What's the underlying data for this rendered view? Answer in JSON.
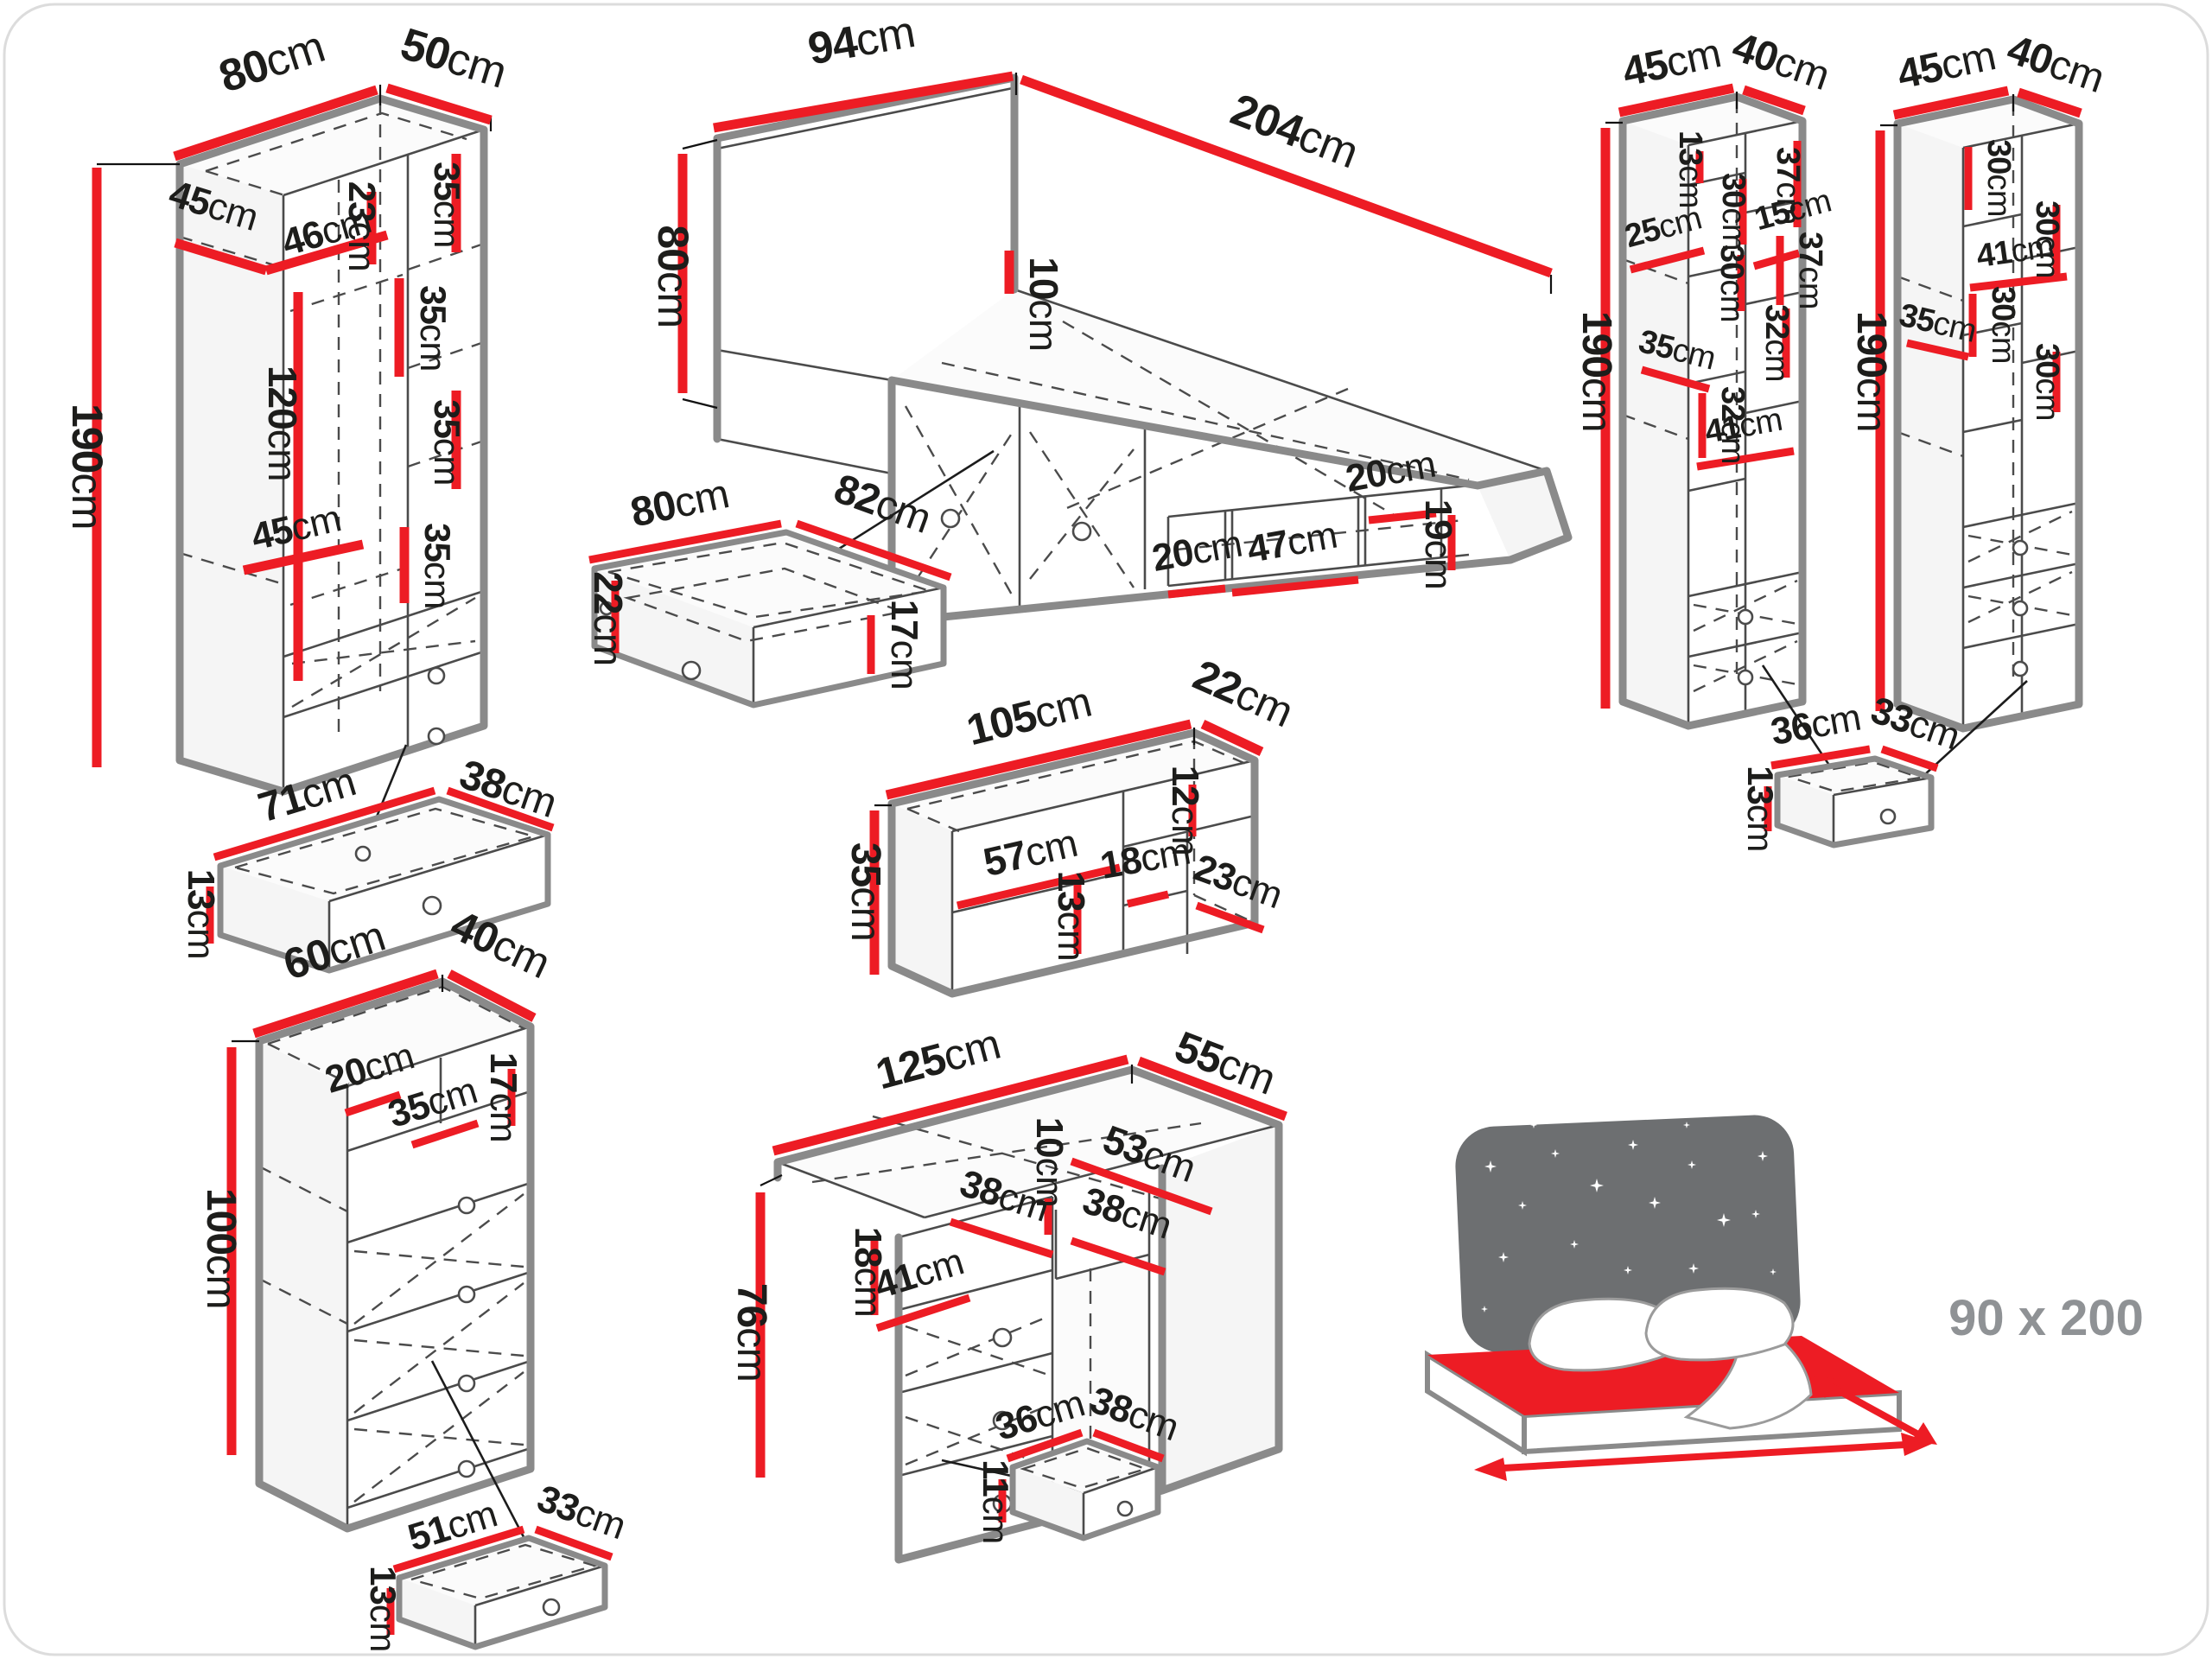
{
  "colors": {
    "accent_red": "#ed1c24",
    "edge_gray": "#8a8a8a",
    "text_black": "#1d1d1b",
    "icon_gray": "#6d6f71",
    "size_text_gray": "#8f9295"
  },
  "bed_size_label": "90 x 200",
  "wardrobe": {
    "width": "80cm",
    "depth": "50cm",
    "height": "190cm",
    "inner_depth": "45cm",
    "inner_width": "46cm",
    "top_shelf_height": "23cm",
    "right_shelf_1": "35cm",
    "right_shelf_2": "35cm",
    "right_shelf_3": "35cm",
    "hanging_height": "120cm",
    "mid_shelf_width": "45cm",
    "mid_shelf_height": "35cm"
  },
  "wardrobe_drawer": {
    "width": "71cm",
    "depth": "38cm",
    "height": "13cm"
  },
  "bed": {
    "headboard_width": "94cm",
    "length": "204cm",
    "headboard_height": "80cm",
    "headboard_top": "10cm",
    "niche_left": "20cm",
    "niche_middle": "47cm",
    "niche_right": "20cm",
    "niche_height": "19cm"
  },
  "bed_drawer": {
    "width": "80cm",
    "depth": "82cm",
    "height": "22cm",
    "inner_height": "17cm"
  },
  "shelf_unit": {
    "width": "105cm",
    "depth": "22cm",
    "height": "35cm",
    "opening_width": "57cm",
    "divider_height": "13cm",
    "right_top_height": "12cm",
    "nook_width": "18cm",
    "nook_bottom": "23cm"
  },
  "chest": {
    "width": "60cm",
    "depth": "40cm",
    "height": "100cm",
    "niche_width": "20cm",
    "niche_shelf": "35cm",
    "niche_height": "17cm"
  },
  "chest_drawer": {
    "width": "51cm",
    "depth": "33cm",
    "height": "13cm"
  },
  "desk": {
    "width": "125cm",
    "depth": "55cm",
    "height": "76cm",
    "side_depth": "53cm",
    "niche_depth": "38cm",
    "niche_drop": "10cm",
    "drawer_width": "38cm",
    "shelf_height": "18cm",
    "shelf_width": "41cm"
  },
  "desk_drawer": {
    "width": "36cm",
    "depth": "38cm",
    "height": "11cm"
  },
  "bookcase_left": {
    "width": "45cm",
    "depth": "40cm",
    "height": "190cm",
    "dim1": "13cm",
    "dim2": "30cm",
    "dim3": "37cm",
    "dim4": "25cm",
    "dim5": "15cm",
    "dim6": "30cm",
    "dim7": "37cm",
    "dim8": "32cm",
    "dim9": "35cm",
    "dim10": "32cm",
    "dim11": "41cm"
  },
  "bookcase_right": {
    "width": "45cm",
    "depth": "40cm",
    "height": "190cm",
    "dim1": "30cm",
    "dim2": "30cm",
    "dim3": "41cm",
    "dim4": "30cm",
    "dim5": "35cm",
    "dim6": "30cm"
  },
  "bookcase_drawer": {
    "width": "36cm",
    "depth": "33cm",
    "height": "13cm"
  }
}
